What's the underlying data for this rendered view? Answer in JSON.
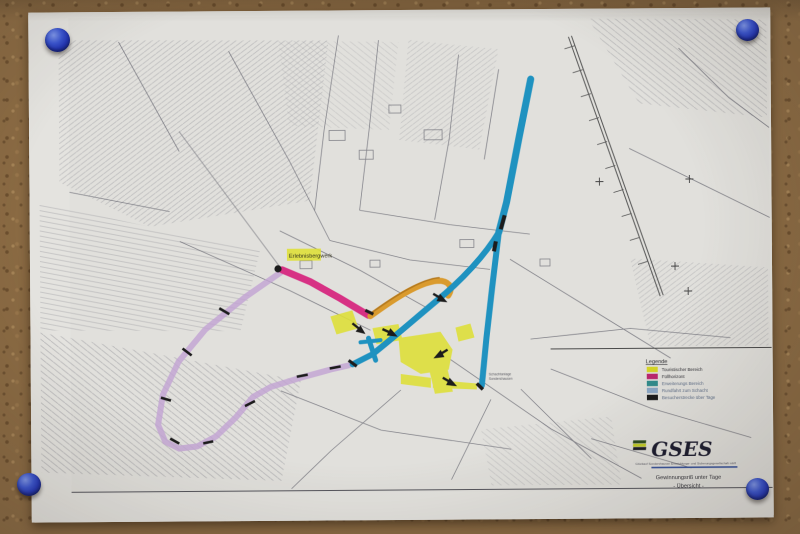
{
  "photo": {
    "board_material": "cork-board",
    "board_color": "#8a6a43",
    "pin_color": "#2336b4",
    "pin_count": 4
  },
  "map": {
    "highlight_label": "Erlebnisbergwerk",
    "shaft_label_line1": "Schachtanlage",
    "shaft_label_line2": "Sondershausen",
    "route_colors": {
      "pink": "#de2f86",
      "orange": "#dd9b28",
      "purple": "#c3a3d6",
      "cyan": "#1a93c4",
      "yellow": "#dfe02e",
      "marks": "#1c1c1c"
    }
  },
  "legend": {
    "title": "Legende",
    "items": [
      {
        "label": "Touristischer Bereich",
        "color": "#d6d61e"
      },
      {
        "label": "Füllhorizont",
        "color": "#c02570"
      },
      {
        "label": "Erweiterungs Bereich",
        "color": "#2e8c8c"
      },
      {
        "label": "Rundfahrt zum Schacht",
        "color": "#8aa6c6"
      },
      {
        "label": "Besucherstrecke über Tage",
        "color": "#1a1a1a"
      }
    ]
  },
  "title_block": {
    "logo_text": "GSES",
    "company_line": "Glückauf Sondershausen Entwicklungs- und Sicherungsgesellschaft mbH",
    "caption_line1": "Gewinnungsriß unter Tage",
    "caption_line2": "- Übersicht -"
  }
}
